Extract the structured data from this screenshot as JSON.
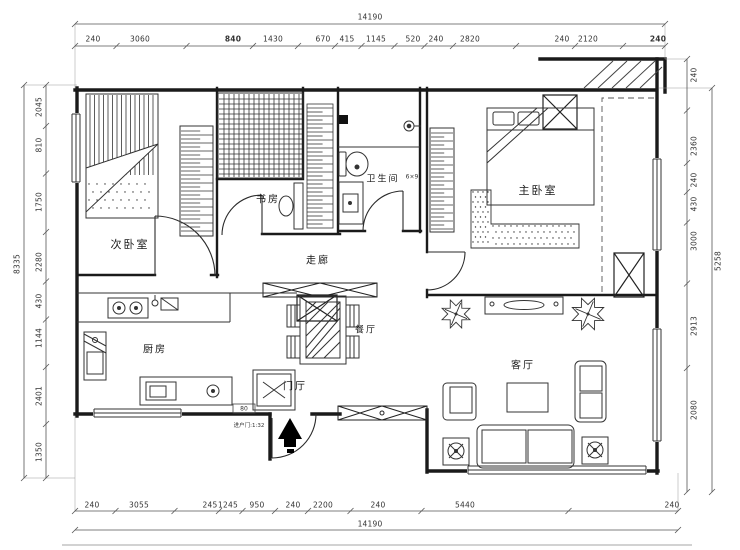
{
  "rooms": [
    {
      "id": "secondary-bedroom",
      "label": "次卧室",
      "x": 130,
      "y": 244,
      "size": 11
    },
    {
      "id": "study",
      "label": "书房",
      "x": 268,
      "y": 198,
      "size": 10
    },
    {
      "id": "bathroom",
      "label": "卫生间",
      "x": 383,
      "y": 178,
      "size": 9
    },
    {
      "id": "master-bedroom",
      "label": "主卧室",
      "x": 538,
      "y": 190,
      "size": 11
    },
    {
      "id": "corridor",
      "label": "走廊",
      "x": 318,
      "y": 259,
      "size": 10
    },
    {
      "id": "dining-room",
      "label": "餐厅",
      "x": 366,
      "y": 329,
      "size": 9
    },
    {
      "id": "kitchen",
      "label": "厨房",
      "x": 155,
      "y": 348,
      "size": 10
    },
    {
      "id": "foyer",
      "label": "门厅",
      "x": 295,
      "y": 385,
      "size": 10
    },
    {
      "id": "living-room",
      "label": "客厅",
      "x": 523,
      "y": 364,
      "size": 10
    }
  ],
  "annotations": [
    {
      "id": "entry-door-note",
      "text": "进户门:1:32",
      "x": 249,
      "y": 425,
      "size": 5.5
    },
    {
      "id": "dim-80",
      "text": "80",
      "x": 244,
      "y": 409,
      "size": 6
    },
    {
      "id": "bathroom-size-note",
      "text": "6×9",
      "x": 412,
      "y": 177,
      "size": 6
    }
  ],
  "dimensions": {
    "top": {
      "total": {
        "text": "14190",
        "x": 370,
        "y": 17
      },
      "total_line": {
        "x0": 75,
        "x1": 665,
        "y": 24
      },
      "seg_line": {
        "x0": 75,
        "x1": 665,
        "y": 46
      },
      "seg_y": 39,
      "segments": [
        {
          "t": "240",
          "c": 93
        },
        {
          "t": "3060",
          "c": 140
        },
        {
          "t": "840",
          "c": 233,
          "b": 1
        },
        {
          "t": "1430",
          "c": 273
        },
        {
          "t": "670",
          "c": 323
        },
        {
          "t": "415",
          "c": 347
        },
        {
          "t": "1145",
          "c": 376
        },
        {
          "t": "520",
          "c": 413
        },
        {
          "t": "240",
          "c": 436
        },
        {
          "t": "2820",
          "c": 470
        },
        {
          "t": "240",
          "c": 562
        },
        {
          "t": "2120",
          "c": 588
        },
        {
          "t": "240",
          "c": 658,
          "b": 1
        }
      ]
    },
    "bottom": {
      "total": {
        "text": "14190",
        "x": 370,
        "y": 524
      },
      "total_line": {
        "x0": 75,
        "x1": 678,
        "y": 530
      },
      "seg_line": {
        "x0": 75,
        "x1": 678,
        "y": 511
      },
      "seg_y": 505,
      "segments": [
        {
          "t": "240",
          "c": 92
        },
        {
          "t": "3055",
          "c": 139
        },
        {
          "t": "245",
          "c": 210
        },
        {
          "t": "1245",
          "c": 228
        },
        {
          "t": "950",
          "c": 257
        },
        {
          "t": "240",
          "c": 293
        },
        {
          "t": "2200",
          "c": 323
        },
        {
          "t": "240",
          "c": 378
        },
        {
          "t": "5440",
          "c": 465
        },
        {
          "t": "240",
          "c": 672
        }
      ]
    },
    "left": {
      "total": {
        "text": "8335",
        "x": 17,
        "y": 264
      },
      "total_line": {
        "y0": 85,
        "y1": 478,
        "x": 24
      },
      "seg_line": {
        "y0": 85,
        "y1": 478,
        "x": 46
      },
      "seg_x": 39,
      "segments": [
        {
          "t": "2045",
          "c": 107
        },
        {
          "t": "810",
          "c": 145
        },
        {
          "t": "1750",
          "c": 202
        },
        {
          "t": "2280",
          "c": 262
        },
        {
          "t": "430",
          "c": 301
        },
        {
          "t": "1144",
          "c": 338
        },
        {
          "t": "2401",
          "c": 396
        },
        {
          "t": "1350",
          "c": 452
        }
      ]
    },
    "right": {
      "total": {
        "text": "5258",
        "x": 718,
        "y": 261
      },
      "total_line": {
        "y0": 88,
        "y1": 492,
        "x": 712
      },
      "seg_line": {
        "y0": 59,
        "y1": 492,
        "x": 687
      },
      "seg_x": 694,
      "segments": [
        {
          "t": "240",
          "c": 75
        },
        {
          "t": "2360",
          "c": 146
        },
        {
          "t": "240",
          "c": 180
        },
        {
          "t": "430",
          "c": 204
        },
        {
          "t": "3000",
          "c": 241
        },
        {
          "t": "2913",
          "c": 326
        },
        {
          "t": "2080",
          "c": 410
        }
      ]
    }
  },
  "frame_line": {
    "x0": 62,
    "x1": 692,
    "y": 545
  },
  "colors": {
    "wall": "#1a1a1a",
    "furniture": "#333333",
    "dimension": "#555555",
    "text": "#222222"
  }
}
